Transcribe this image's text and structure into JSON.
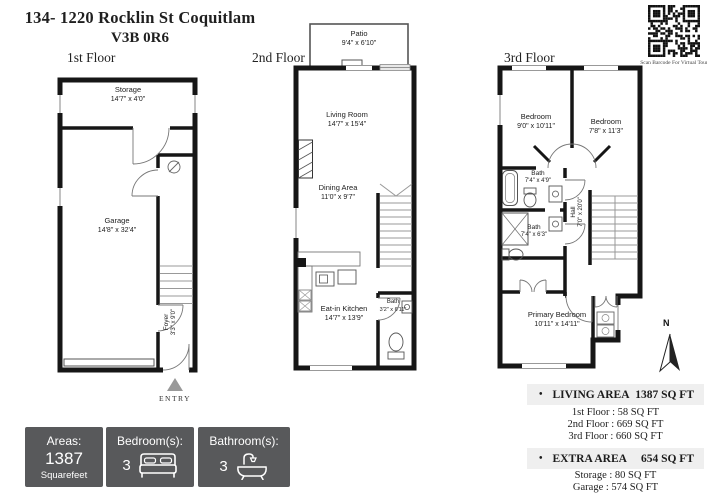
{
  "header": {
    "title_line1": "134- 1220 Rocklin St Coquitlam",
    "title_line2": "V3B 0R6",
    "qr_caption": "Scan Barcode For Virtual Tour"
  },
  "floors": {
    "f1": {
      "label": "1st Floor",
      "entry": "ENTRY",
      "rooms": {
        "storage": {
          "name": "Storage",
          "dims": "14'7\" x 4'0\""
        },
        "garage": {
          "name": "Garage",
          "dims": "14'8\" x 32'4\""
        },
        "foyer": {
          "name": "Foyer",
          "dims": "3'3\" x 9'0\""
        }
      }
    },
    "f2": {
      "label": "2nd Floor",
      "rooms": {
        "patio": {
          "name": "Patio",
          "dims": "9'4\" x 6'10\""
        },
        "living": {
          "name": "Living Room",
          "dims": "14'7\" x 15'4\""
        },
        "dining": {
          "name": "Dining Area",
          "dims": "11'0\" x 9'7\""
        },
        "kitchen": {
          "name": "Eat-in Kitchen",
          "dims": "14'7\" x 13'9\""
        },
        "bath": {
          "name": "Bath",
          "dims": "3'2\" x 6'11\""
        }
      }
    },
    "f3": {
      "label": "3rd Floor",
      "rooms": {
        "bedroom_left": {
          "name": "Bedroom",
          "dims": "9'0\" x 10'11\""
        },
        "bedroom_right": {
          "name": "Bedroom",
          "dims": "7'8\" x 11'3\""
        },
        "bath_top": {
          "name": "Bath",
          "dims": "7'4\" x 4'9\""
        },
        "bath_mid": {
          "name": "Bath",
          "dims": "7'4\" x 6'3\""
        },
        "hall": {
          "name": "Hall",
          "dims": "7'0\" x 20'0\""
        },
        "primary": {
          "name": "Primary Bedroom",
          "dims": "10'11\" x 14'11\""
        }
      }
    }
  },
  "compass": {
    "north_label": "N"
  },
  "badges": {
    "areas": {
      "label": "Areas:",
      "value": "1387",
      "unit": "Squarefeet"
    },
    "bedrooms": {
      "label": "Bedroom(s):",
      "count": "3"
    },
    "bathrooms": {
      "label": "Bathroom(s):",
      "count": "3"
    }
  },
  "summary": {
    "living": {
      "bullet": "•",
      "label": "LIVING AREA",
      "value": "1387 SQ FT"
    },
    "living_breakdown": [
      "1st Floor : 58 SQ FT",
      "2nd Floor : 669 SQ FT",
      "3rd Floor : 660 SQ FT"
    ],
    "extra": {
      "bullet": "•",
      "label": "EXTRA AREA",
      "value": "654 SQ FT"
    },
    "extra_breakdown": [
      "Storage : 80 SQ FT",
      "Garage : 574 SQ FT"
    ]
  },
  "colors": {
    "wall": "#161616",
    "badge_bg": "#58595b",
    "band_bg": "#efefef",
    "entry_arrow": "#999999"
  }
}
